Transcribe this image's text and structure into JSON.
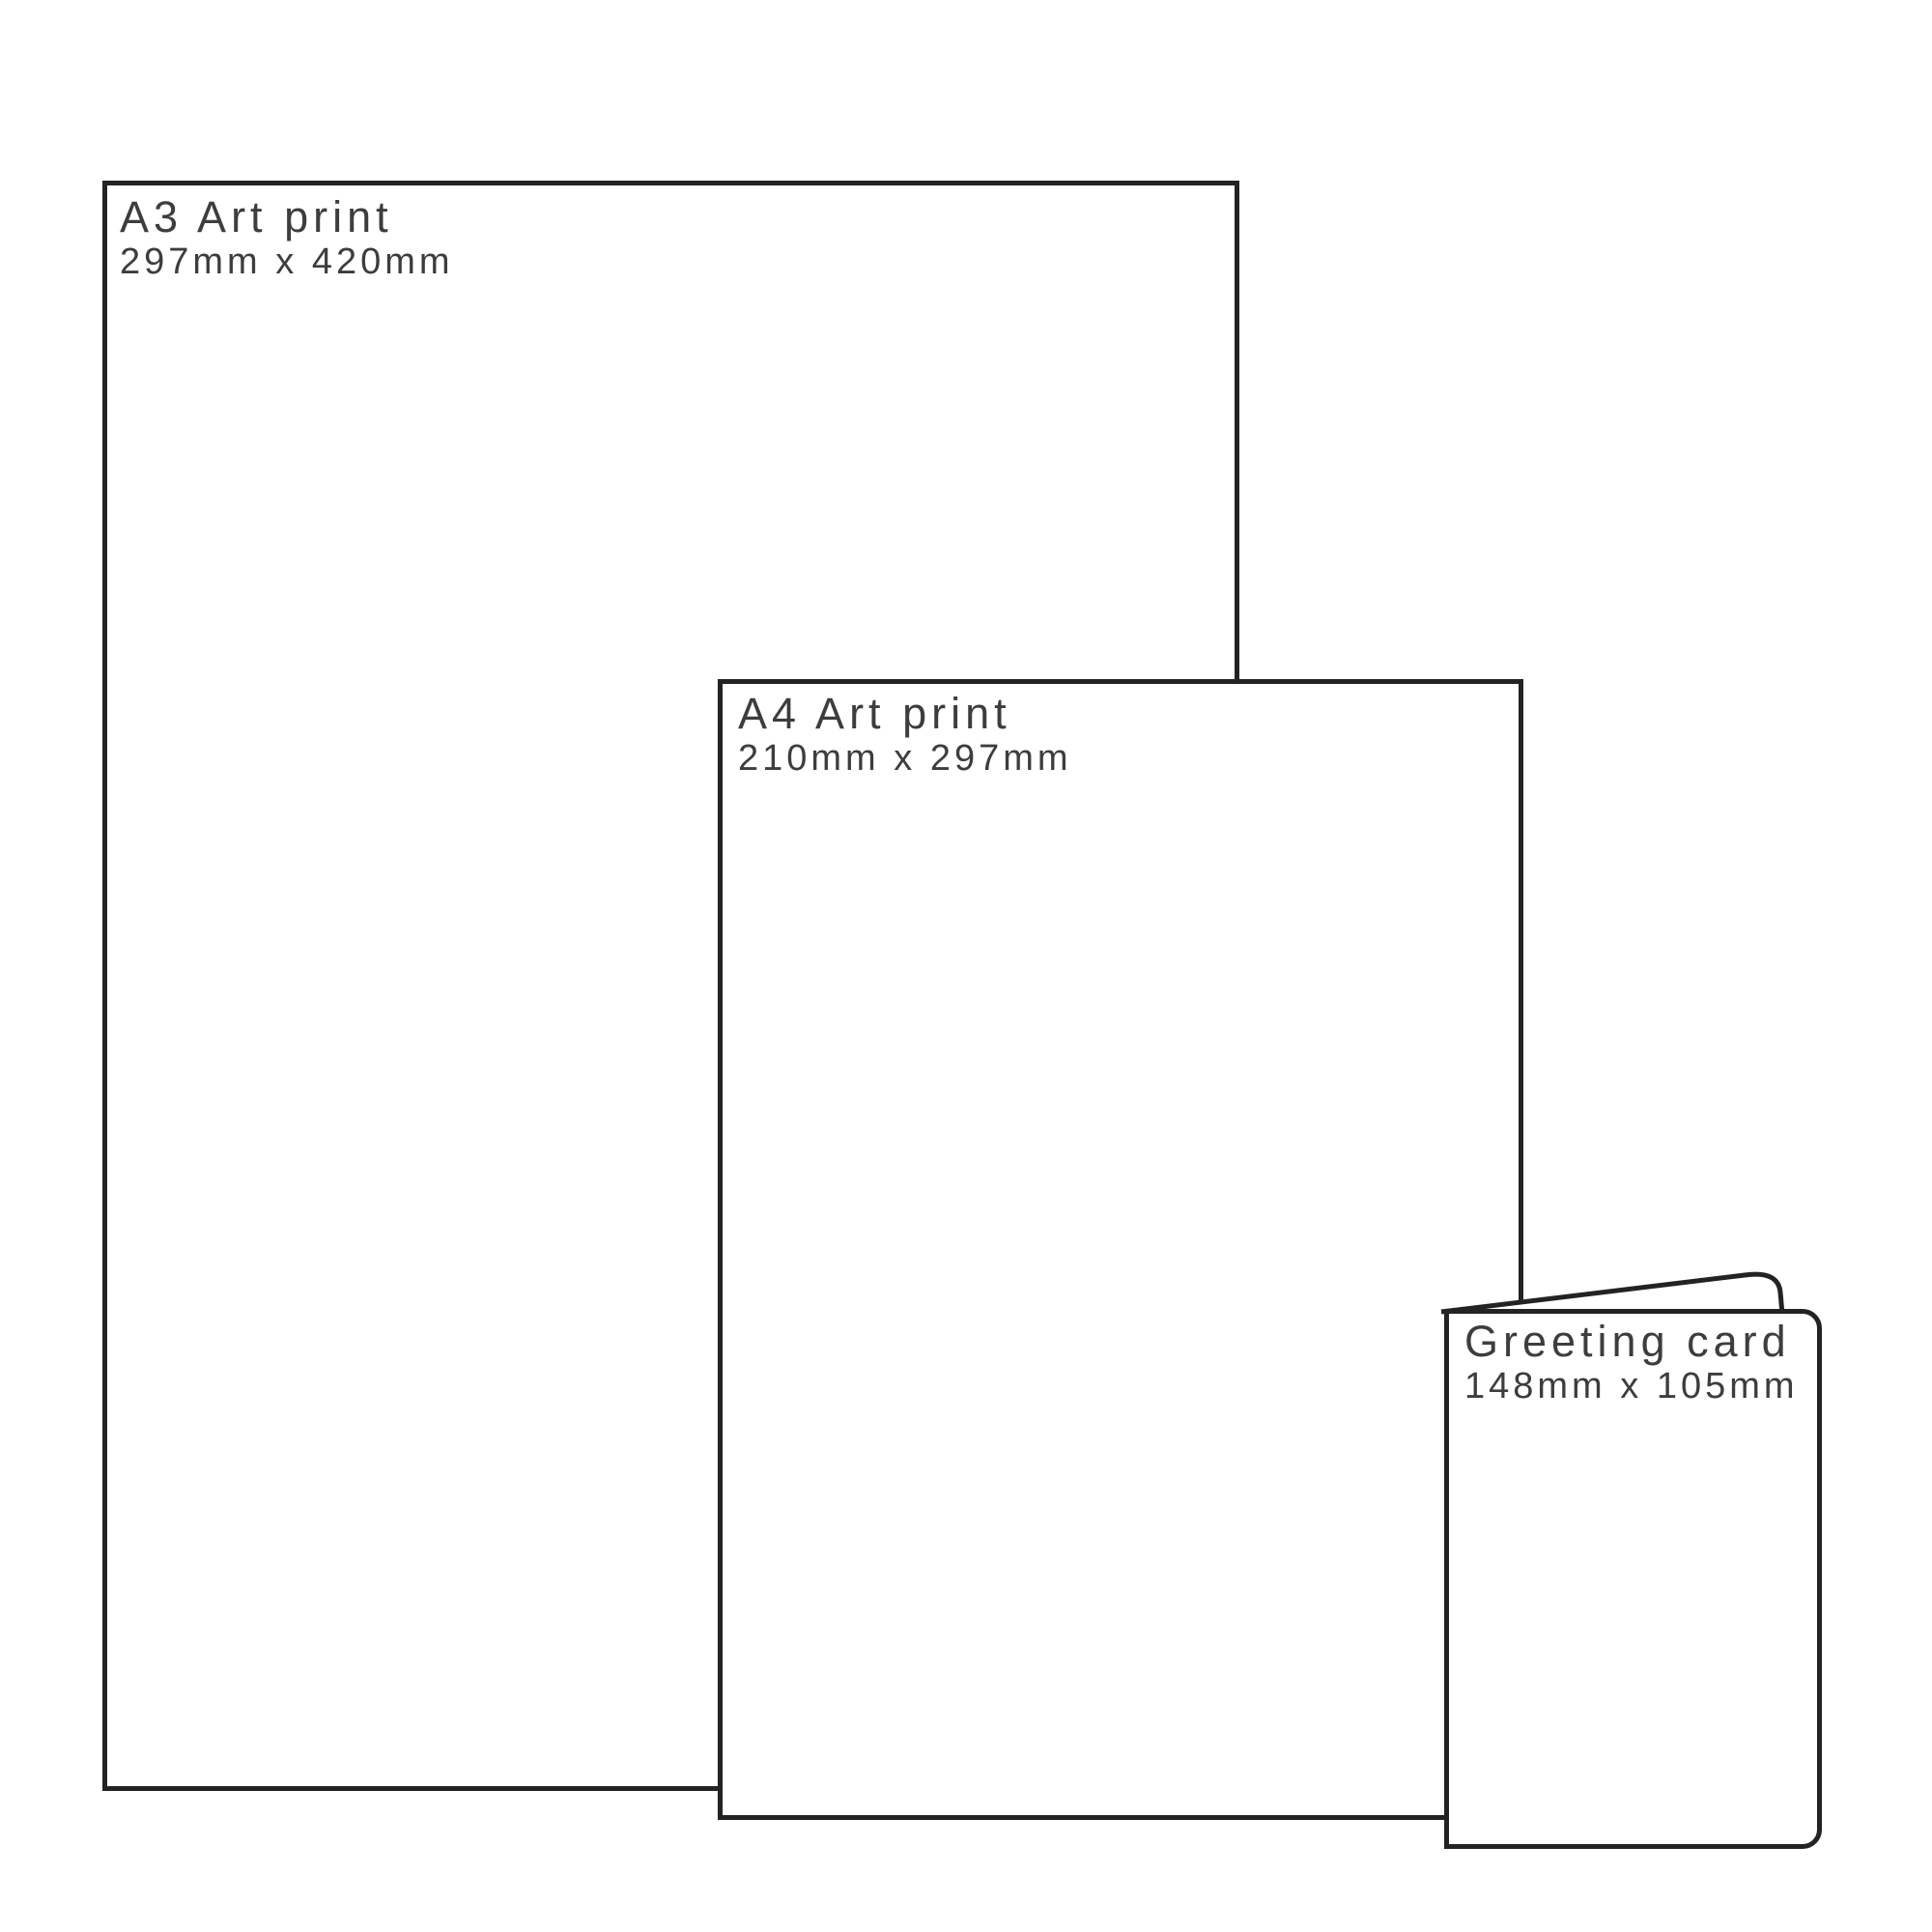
{
  "graphic": {
    "background": "#ffffff",
    "outline_color": "#232323",
    "label_color": "#3d3d3d",
    "products": [
      {
        "name": "A3 Art print",
        "size": "297mm x 420mm"
      },
      {
        "name": "A4 Art print",
        "size": "210mm x 297mm"
      },
      {
        "name": "Greeting card",
        "size": "148mm x 105mm"
      }
    ]
  }
}
